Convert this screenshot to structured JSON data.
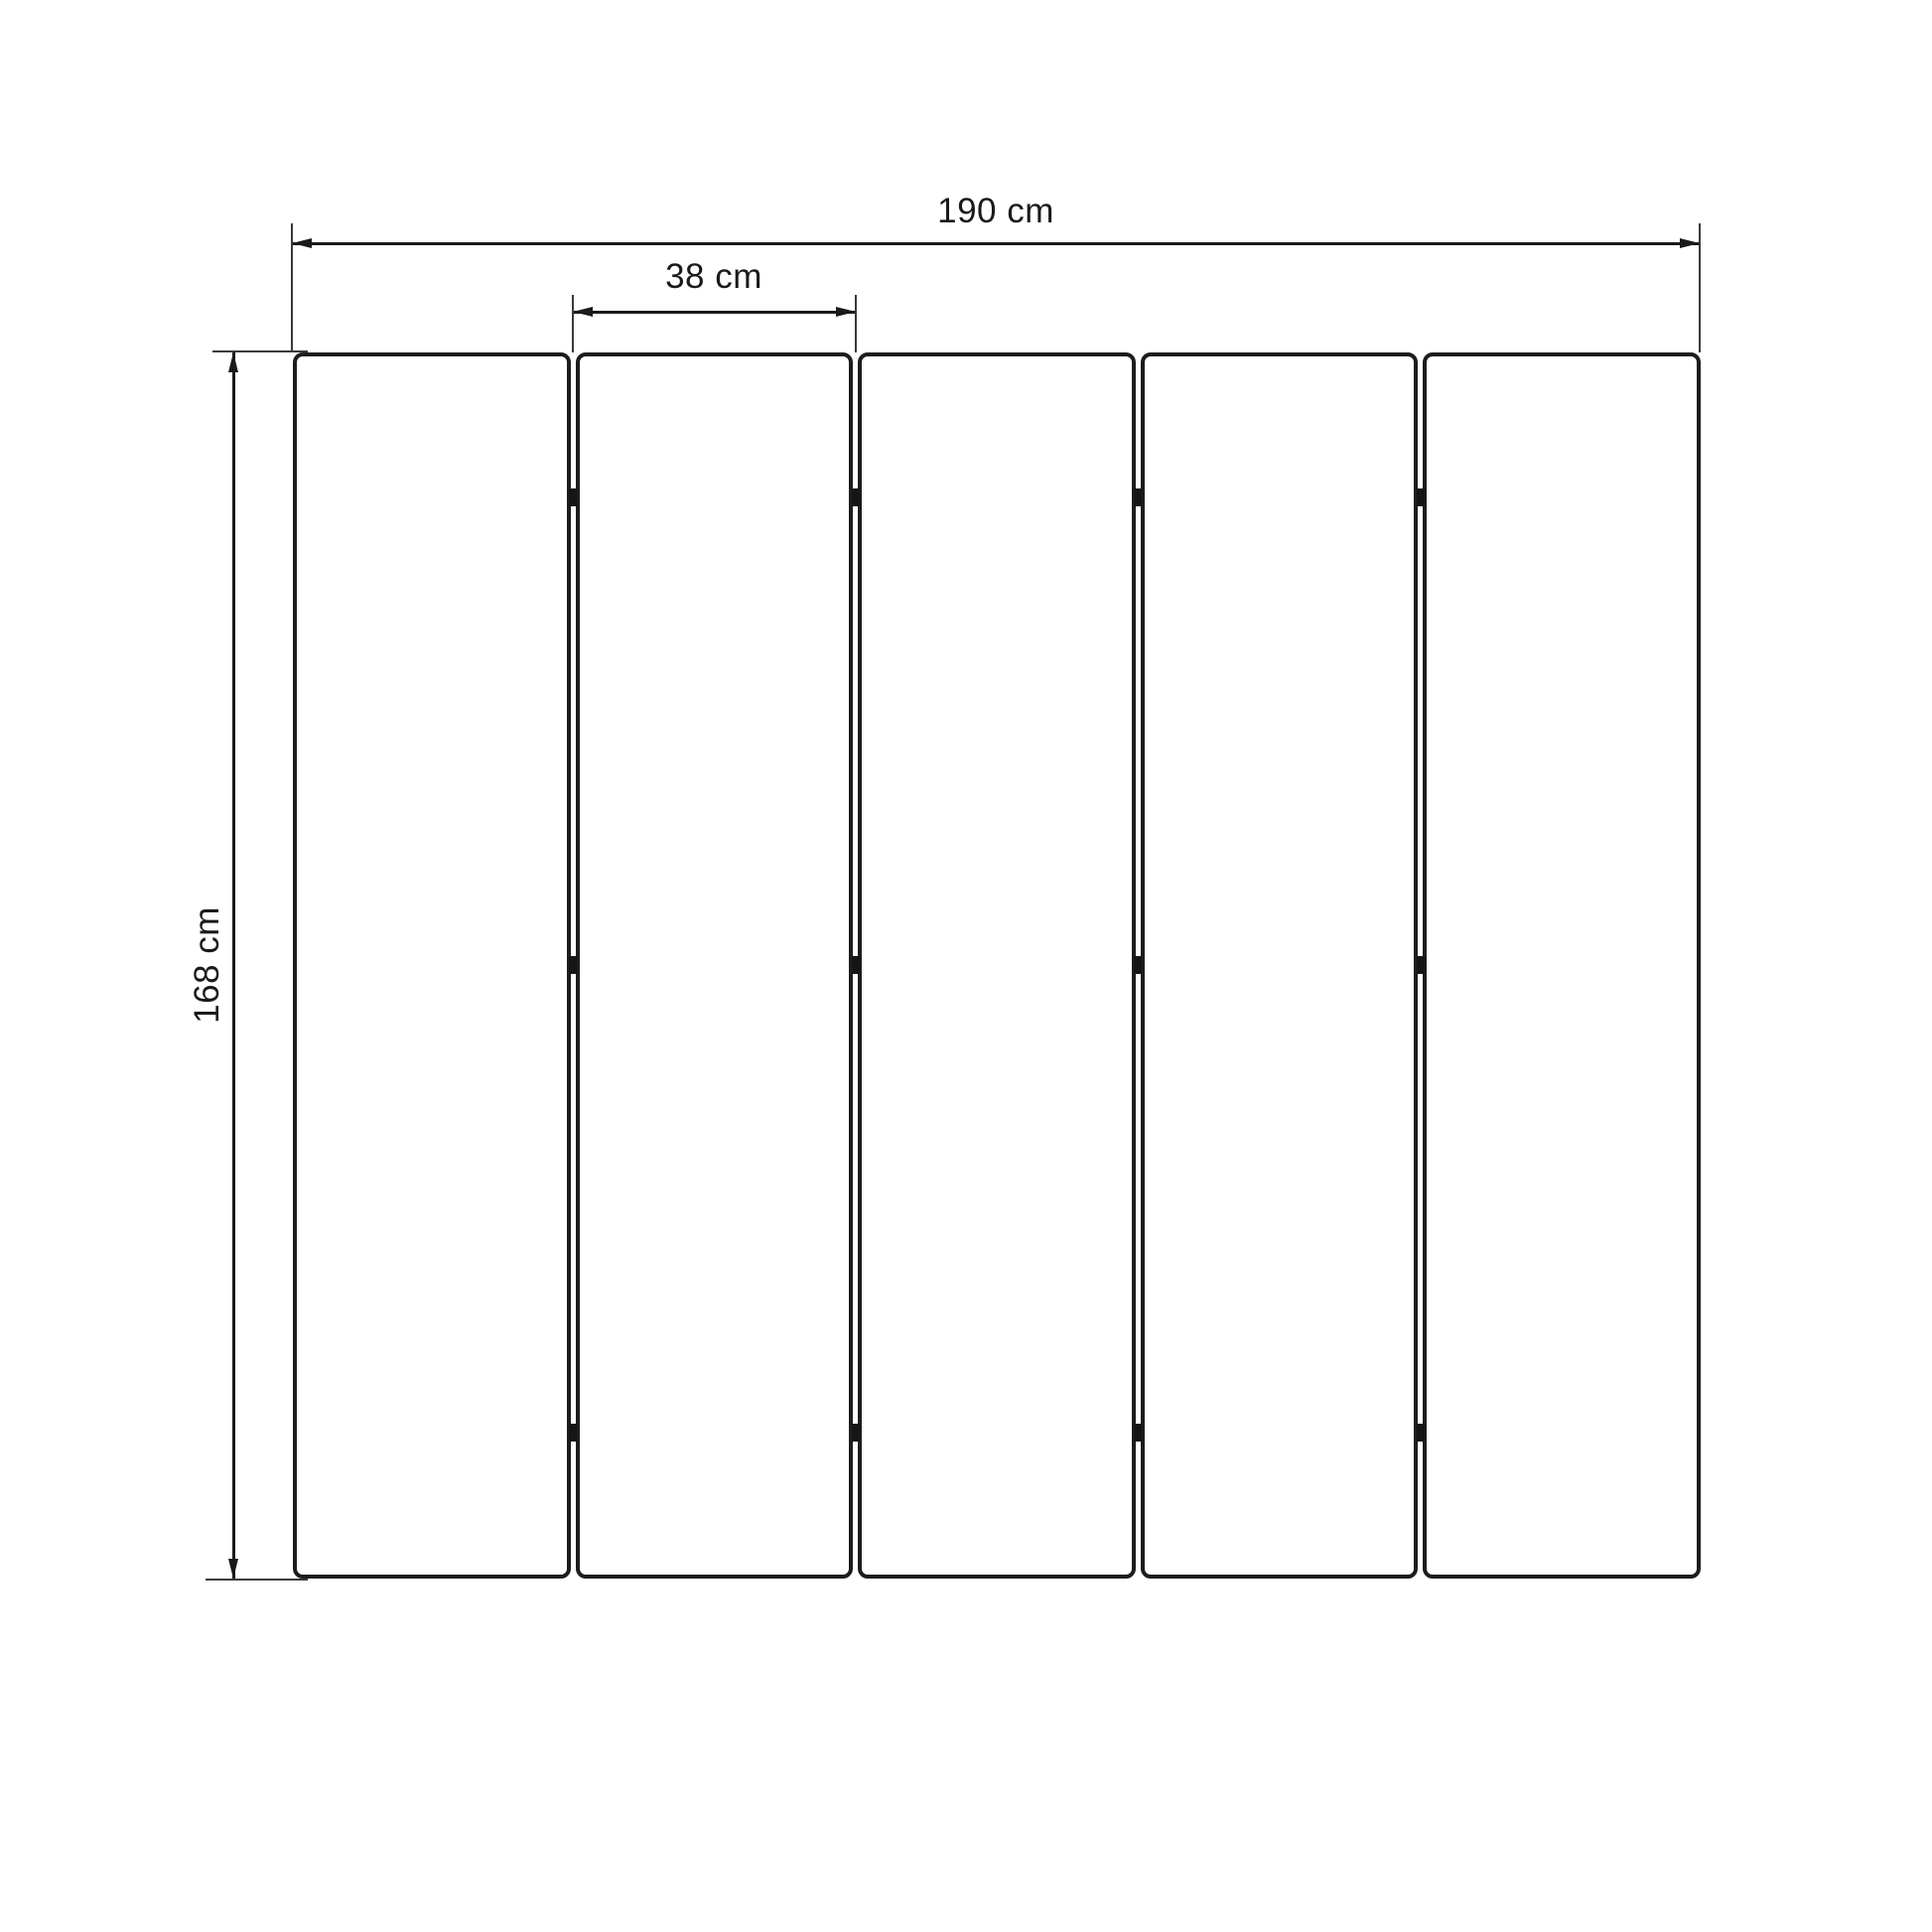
{
  "page": {
    "background_color": "#ffffff",
    "line_color": "#1a1a1a"
  },
  "diagram": {
    "type": "folding-screen-front-view-technical-drawing",
    "panel_count": 5,
    "gap_count": 4,
    "hinges_per_gap": 3,
    "dimensions": {
      "total_width": "190 cm",
      "panel_width": "38 cm",
      "height": "168 cm"
    }
  }
}
